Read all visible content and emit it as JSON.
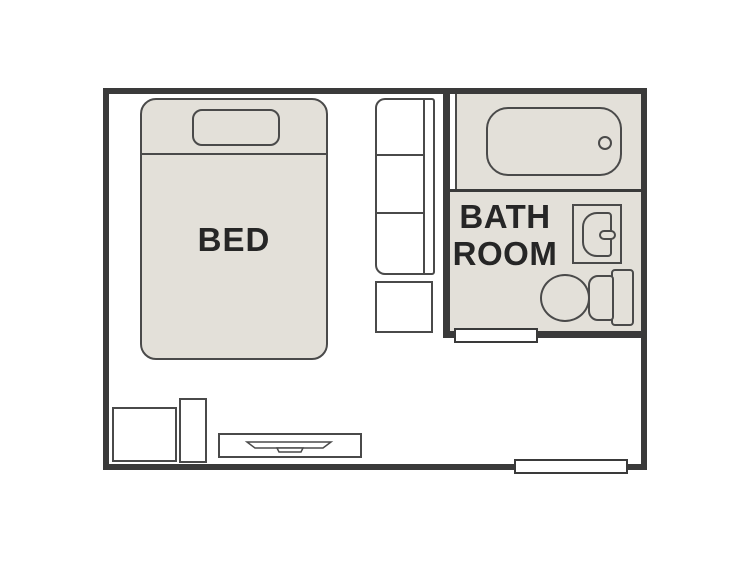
{
  "floorplan": {
    "rooms": {
      "bedroom": {
        "label": "BED"
      },
      "bathroom": {
        "label_line1": "BATH",
        "label_line2": "ROOM"
      }
    },
    "fixtures": [
      "bed",
      "pillow",
      "closet",
      "storage-box",
      "bathtub",
      "bathtub-drain",
      "sink",
      "faucet",
      "toilet",
      "bathroom-door-opening",
      "entrance-door-opening",
      "cabinet-box",
      "tall-cabinet",
      "tv-stand",
      "tv"
    ],
    "colors": {
      "wall": "#3a3a3a",
      "line": "#4a4a4a",
      "fill": "#e3e0d9",
      "floor": "#ffffff",
      "label": "#262626"
    }
  }
}
